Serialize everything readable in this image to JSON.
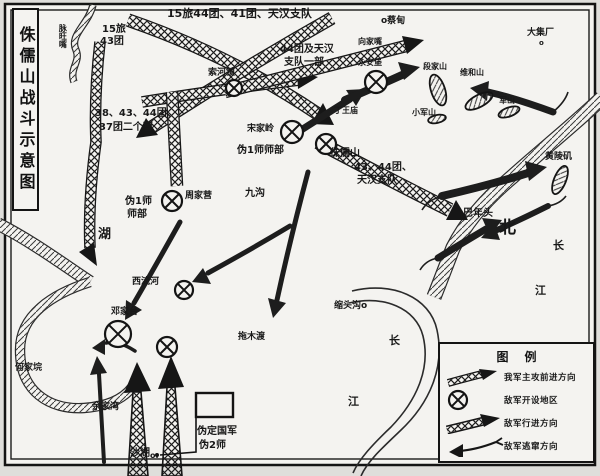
{
  "title": {
    "text": "侏儒山战斗示意图"
  },
  "legend": {
    "title": "图例",
    "items": [
      {
        "symbol": "friendly-attack-arrow",
        "label": "我军主攻前进方向"
      },
      {
        "symbol": "enemy-area-mark",
        "label": "敌军开设地区"
      },
      {
        "symbol": "enemy-advance-arrow",
        "label": "敌军行进方向"
      },
      {
        "symbol": "enemy-flee-arrow",
        "label": "敌军逃窜方向"
      }
    ]
  },
  "colors": {
    "paper": "#f4f3f0",
    "ink": "#1c1c1c"
  },
  "map": {
    "labels": [
      {
        "t": "15旅44团、41团、天汉支队",
        "x": 167,
        "y": 8,
        "s": 11
      },
      {
        "t": "15旅",
        "x": 102,
        "y": 25,
        "s": 10
      },
      {
        "t": "43团",
        "x": 100,
        "y": 37,
        "s": 10
      },
      {
        "t": "脉旺嘴",
        "x": 58,
        "y": 24,
        "s": 8,
        "v": 1
      },
      {
        "t": "o蔡甸",
        "x": 381,
        "y": 17,
        "s": 9
      },
      {
        "t": "大集厂",
        "x": 527,
        "y": 29,
        "s": 9
      },
      {
        "t": "o",
        "x": 539,
        "y": 40,
        "s": 7
      },
      {
        "t": "段家山",
        "x": 423,
        "y": 63,
        "s": 8
      },
      {
        "t": "维和山",
        "x": 460,
        "y": 69,
        "s": 8
      },
      {
        "t": "军山",
        "x": 499,
        "y": 97,
        "s": 8
      },
      {
        "t": "小军山",
        "x": 412,
        "y": 109,
        "s": 8
      },
      {
        "t": "44团及天汉",
        "x": 280,
        "y": 45,
        "s": 10
      },
      {
        "t": "支队一部",
        "x": 284,
        "y": 58,
        "s": 10
      },
      {
        "t": "向家嘴",
        "x": 358,
        "y": 38,
        "s": 8
      },
      {
        "t": "永安堡",
        "x": 358,
        "y": 59,
        "s": 8
      },
      {
        "t": "索河镇",
        "x": 208,
        "y": 69,
        "s": 9
      },
      {
        "t": "38、43、44团、",
        "x": 95,
        "y": 109,
        "s": 10
      },
      {
        "t": "37团二个营",
        "x": 99,
        "y": 123,
        "s": 10
      },
      {
        "t": "丁王庙",
        "x": 334,
        "y": 107,
        "s": 8
      },
      {
        "t": "宋家岭",
        "x": 247,
        "y": 125,
        "s": 9
      },
      {
        "t": "伪1师师部",
        "x": 237,
        "y": 146,
        "s": 10
      },
      {
        "t": "侏儒山",
        "x": 330,
        "y": 149,
        "s": 10
      },
      {
        "t": "43、44团、",
        "x": 354,
        "y": 163,
        "s": 10
      },
      {
        "t": "天汉支队",
        "x": 357,
        "y": 176,
        "s": 10
      },
      {
        "t": "伪1师",
        "x": 125,
        "y": 197,
        "s": 10
      },
      {
        "t": "师部",
        "x": 127,
        "y": 210,
        "s": 10
      },
      {
        "t": "周家营",
        "x": 185,
        "y": 192,
        "s": 9
      },
      {
        "t": "九沟",
        "x": 245,
        "y": 189,
        "s": 10
      },
      {
        "t": "湖",
        "x": 98,
        "y": 228,
        "s": 13
      },
      {
        "t": "北",
        "x": 499,
        "y": 220,
        "s": 17
      },
      {
        "t": "长",
        "x": 553,
        "y": 240,
        "s": 11
      },
      {
        "t": "江",
        "x": 535,
        "y": 285,
        "s": 11
      },
      {
        "t": "黄陵矶",
        "x": 545,
        "y": 153,
        "s": 9
      },
      {
        "t": "巴年头",
        "x": 463,
        "y": 209,
        "s": 10
      },
      {
        "t": "缩头沟o",
        "x": 334,
        "y": 302,
        "s": 9
      },
      {
        "t": "拖木渡",
        "x": 238,
        "y": 333,
        "s": 9
      },
      {
        "t": "西流河",
        "x": 132,
        "y": 278,
        "s": 9
      },
      {
        "t": "邓家台",
        "x": 111,
        "y": 308,
        "s": 9
      },
      {
        "t": "何家垸",
        "x": 15,
        "y": 364,
        "s": 9
      },
      {
        "t": "余家湾",
        "x": 92,
        "y": 403,
        "s": 9
      },
      {
        "t": "长",
        "x": 389,
        "y": 335,
        "s": 11
      },
      {
        "t": "江",
        "x": 348,
        "y": 396,
        "s": 11
      },
      {
        "t": "伪定国军",
        "x": 197,
        "y": 427,
        "s": 10
      },
      {
        "t": "伪2师",
        "x": 199,
        "y": 441,
        "s": 10
      },
      {
        "t": "沙湖",
        "x": 130,
        "y": 449,
        "s": 10
      },
      {
        "t": "o.",
        "x": 150,
        "y": 452,
        "s": 8
      }
    ],
    "markers": [
      {
        "x": 234,
        "y": 88,
        "r": 8
      },
      {
        "x": 376,
        "y": 82,
        "r": 11
      },
      {
        "x": 292,
        "y": 132,
        "r": 11
      },
      {
        "x": 326,
        "y": 144,
        "r": 10
      },
      {
        "x": 172,
        "y": 201,
        "r": 10
      },
      {
        "x": 184,
        "y": 290,
        "r": 9
      },
      {
        "x": 118,
        "y": 334,
        "r": 13
      },
      {
        "x": 167,
        "y": 347,
        "r": 10
      }
    ]
  }
}
